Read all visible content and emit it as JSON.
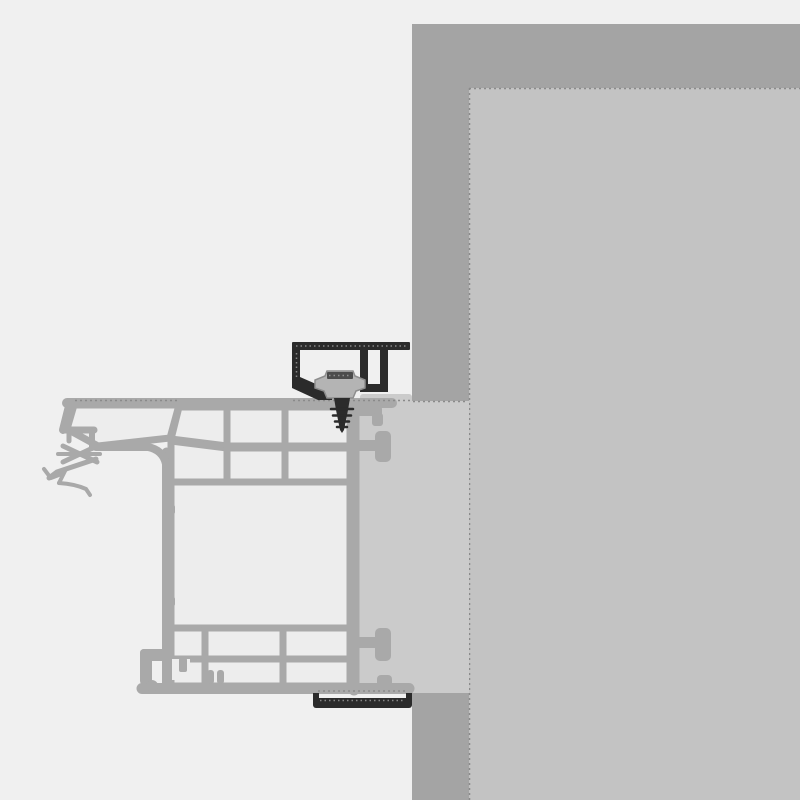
{
  "diagram": {
    "kind": "installation-cross-section",
    "description": "Window frame profile fixed to masonry wall with mounting brackets and screw"
  },
  "colors": {
    "background": "#f0f0f0",
    "wall_outer": "#a4a4a4",
    "wall_inner": "#c3c3c3",
    "installation_gap": "#cbcbcb",
    "profile_stroke": "#a9a9a9",
    "chamber_fill": "#ededed",
    "bracket": "#2b2b2b",
    "screw_head": "#b4b4b4",
    "screw_head_edge": "#8d8d8d",
    "screw_head_hatch": "#4b4b4b",
    "dashed_dark": "#8a8a8a",
    "dashed_light": "#9f9f9f"
  },
  "components": {
    "wall_outer": "exterior-wall-section",
    "wall_inner": "wall-reveal-surface",
    "installation_gap": "installation-gap-fill",
    "frame": "window-frame-profile",
    "chambers": "frame-insulation-chambers",
    "seal": "glazing-gasket-and-seal",
    "foot": "sill-connection-foot",
    "anchor_clips": "frame-anchor-clips",
    "top_bracket": "top-mounting-bracket",
    "screw": "fixing-screw",
    "bottom_bracket": "bottom-support-bracket"
  }
}
